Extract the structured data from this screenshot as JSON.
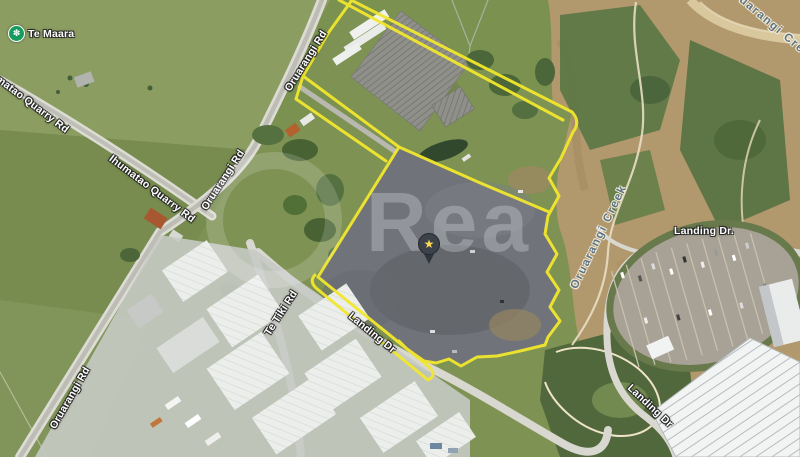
{
  "map": {
    "poi": {
      "te_maara": "Te Maara",
      "icon_glyph": "✽"
    },
    "roads": {
      "ihumatao_quarry_rd": "Ihumatao Quarry Rd",
      "oruarangi_rd": "Oruarangi Rd",
      "te_tiki_rd": "Te Tiki Rd",
      "landing_dr": "Landing Dr",
      "landing_dr_dot": "Landing Dr."
    },
    "water": {
      "creek": "Oruarangi Creek"
    },
    "watermark": "Rea",
    "marker": {
      "icon": "star-pin",
      "glyph": "★"
    },
    "colors": {
      "boundary_yellow": "#f2e72e",
      "poi_green": "#169c5d",
      "water_label": "#5e7480"
    }
  }
}
